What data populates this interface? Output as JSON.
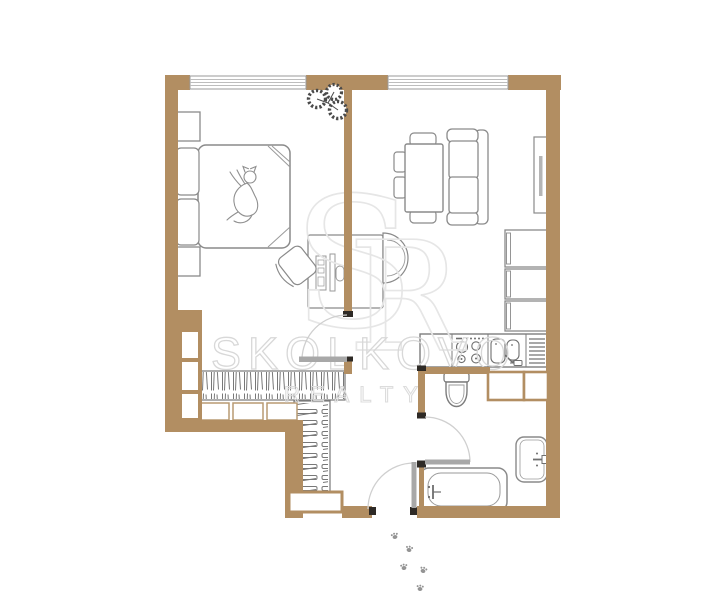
{
  "watermark": {
    "name": "SKOLKOVO",
    "division": "REALTY",
    "monogram_s": "S",
    "monogram_r": "R"
  },
  "palette": {
    "wall": "#b28e62",
    "wall_marker": "#2e2a26",
    "furniture_line": "#8a8a8a",
    "detail_line": "#9a9a9a",
    "door_leaf": "#a8a8a8",
    "door_arc": "#cfcfcf",
    "watermark_text": "#d8d8d8",
    "watermark_monogram": "#e6e6e6",
    "plant": "#4a4a4a",
    "paw": "#949494",
    "floor": "#ffffff"
  },
  "icons": [
    {
      "name": "plant-icon",
      "meaning": "monstera plant on windowsill"
    },
    {
      "name": "cat-icon",
      "meaning": "cat lying on bed"
    },
    {
      "name": "paw-prints-icon",
      "meaning": "cat paw prints at entrance"
    }
  ],
  "plan_features": [
    "bedroom-bed",
    "nightstands",
    "bedroom-closet",
    "wardrobe-horizontal",
    "wardrobe-vertical",
    "back-to-back-desks",
    "dining-table-with-chairs",
    "sofa",
    "tv-panel",
    "kitchen-tall-units",
    "kitchen-counter-stove-sink",
    "toilet",
    "bathtub",
    "bathroom-sink",
    "vent-shafts",
    "entrance-door",
    "bathroom-door",
    "bedroom-door",
    "windows"
  ]
}
